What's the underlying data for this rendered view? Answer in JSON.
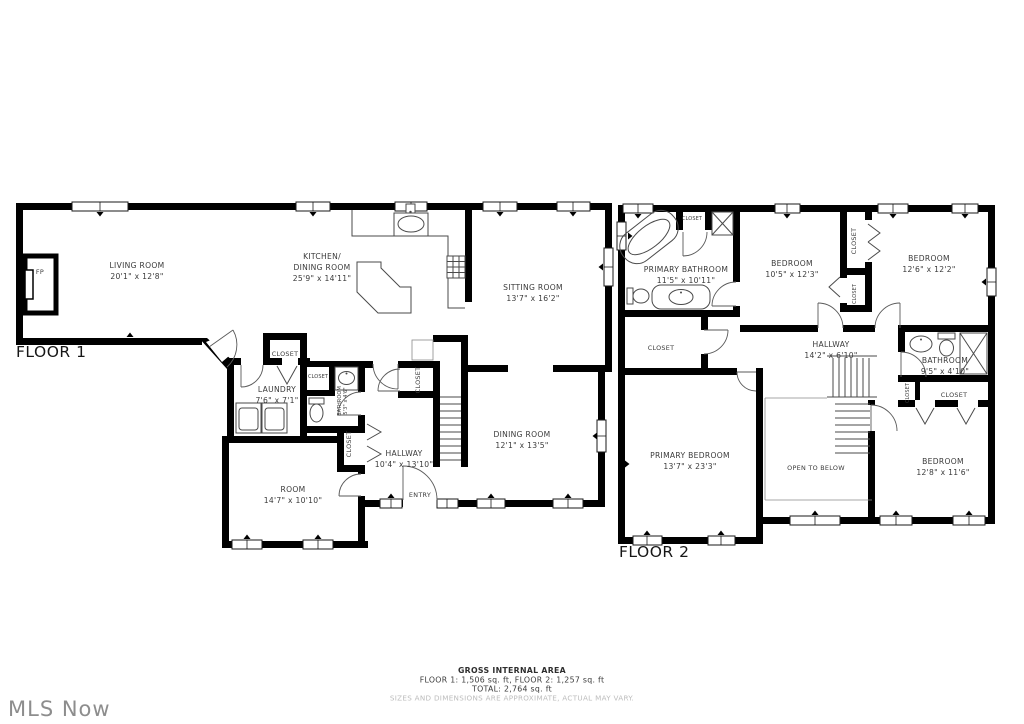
{
  "watermark": "MLS Now",
  "footer": {
    "title": "GROSS INTERNAL AREA",
    "line1": "FLOOR 1: 1,506 sq. ft, FLOOR 2: 1,257 sq. ft",
    "line2": "TOTAL: 2,764 sq. ft",
    "disclaimer": "SIZES AND DIMENSIONS ARE APPROXIMATE, ACTUAL MAY VARY."
  },
  "colors": {
    "wall": "#000000",
    "background": "#ffffff",
    "label": "#3a3a3a",
    "fixture_line": "#4a4a4a",
    "watermark": "#8d8d8d",
    "disclaimer": "#bcbcbc"
  },
  "labels": {
    "closet": "CLOSET",
    "entry": "ENTRY",
    "fireplace": "FP",
    "open_to_below": "OPEN TO BELOW"
  },
  "floor1": {
    "title": "FLOOR 1",
    "living_room": {
      "name": "LIVING ROOM",
      "dims": "20'1\" x 12'8\""
    },
    "kitchen_dining": {
      "name_line1": "KITCHEN/",
      "name_line2": "DINING ROOM",
      "dims": "25'9\" x 14'11\""
    },
    "sitting_room": {
      "name": "SITTING ROOM",
      "dims": "13'7\" x 16'2\""
    },
    "laundry": {
      "name": "LAUNDRY",
      "dims": "7'6\" x 7'1\""
    },
    "bathroom": {
      "name": "BATHROOM",
      "dims": "5'3\" x 4'6\""
    },
    "hallway": {
      "name": "HALLWAY",
      "dims": "10'4\" x 13'10\""
    },
    "dining_room": {
      "name": "DINING ROOM",
      "dims": "12'1\" x 13'5\""
    },
    "room": {
      "name": "ROOM",
      "dims": "14'7\" x 10'10\""
    }
  },
  "floor2": {
    "title": "FLOOR 2",
    "primary_bathroom": {
      "name": "PRIMARY BATHROOM",
      "dims": "11'5\" x 10'11\""
    },
    "bedroom_left": {
      "name": "BEDROOM",
      "dims": "10'5\" x 12'3\""
    },
    "bedroom_right": {
      "name": "BEDROOM",
      "dims": "12'6\" x 12'2\""
    },
    "hallway": {
      "name": "HALLWAY",
      "dims": "14'2\" x 6'10\""
    },
    "bathroom": {
      "name": "BATHROOM",
      "dims": "9'5\" x 4'10\""
    },
    "primary_bedroom": {
      "name": "PRIMARY BEDROOM",
      "dims": "13'7\" x 23'3\""
    },
    "bedroom_bottom": {
      "name": "BEDROOM",
      "dims": "12'8\" x 11'6\""
    }
  }
}
